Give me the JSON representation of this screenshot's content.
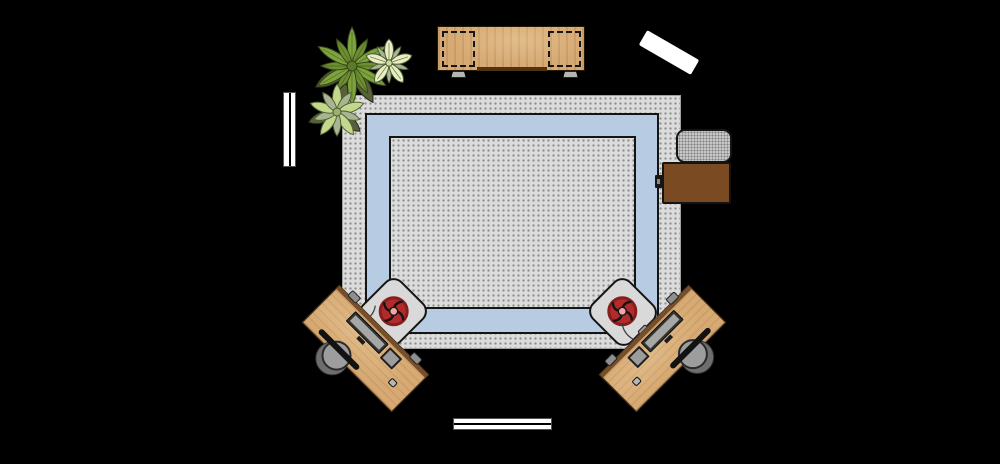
{
  "canvas": {
    "width": 1000,
    "height": 464,
    "background": "#000000"
  },
  "colors": {
    "canvas-bg": "#000000",
    "rug-base": "#dcdcdc",
    "rug-dot": "#8f8f8f",
    "band-blue": "#b7cbe2",
    "outline-dark": "#141414",
    "wood-light": "#d7aa73",
    "wood-mid": "#c99a5f",
    "wood-shadow": "#6b4423",
    "side-table-brown": "#7a4a22",
    "ottoman-gray": "#b5b5b5",
    "chair-body-gray": "#d9d9d9",
    "cushion-red": "#b12b2b",
    "cushion-ring": "#871d1d",
    "cushion-center": "#f2a6a6",
    "monitor-dark": "#343434",
    "monitor-screen": "#a6a8a5",
    "device-gray": "#9c9c9c",
    "seat-gray": "#9d9d9d",
    "white": "#ffffff",
    "leaf-green": "#7da33c",
    "leaf-green-dark": "#6c9030",
    "leaf-olive": "#566039",
    "leaf-light": "#c3d88a",
    "leaf-sage": "#a8b593",
    "petal-cream": "#e9edc3"
  },
  "scene": {
    "description": "Top-down floor plan: home office corner with bordered rug, media console, two angled desks with chairs, plants, ottoman and side table on black background",
    "items": [
      {
        "id": "media-console",
        "label": "Media console"
      },
      {
        "id": "door",
        "label": "Door"
      },
      {
        "id": "window-left",
        "label": "Window (left wall)"
      },
      {
        "id": "window-bottom",
        "label": "Window (bottom wall)"
      },
      {
        "id": "plant-large",
        "label": "Large plant"
      },
      {
        "id": "plant-flowering",
        "label": "Flowering plant"
      },
      {
        "id": "plant-small",
        "label": "Small plant"
      },
      {
        "id": "rug",
        "label": "Dotted rug with blue border band"
      },
      {
        "id": "ottoman",
        "label": "Ottoman"
      },
      {
        "id": "side-table",
        "label": "Side table"
      },
      {
        "id": "desk-left",
        "label": "Desk (left)"
      },
      {
        "id": "desk-right",
        "label": "Desk (right)"
      },
      {
        "id": "armchair-left",
        "label": "Chair with red cushion (left)"
      },
      {
        "id": "armchair-right",
        "label": "Chair with red cushion (right)"
      }
    ],
    "desk_items": {
      "monitor": "Monitor",
      "laptop": "Laptop",
      "mouse": "Mouse",
      "chair": "Task chair"
    }
  }
}
